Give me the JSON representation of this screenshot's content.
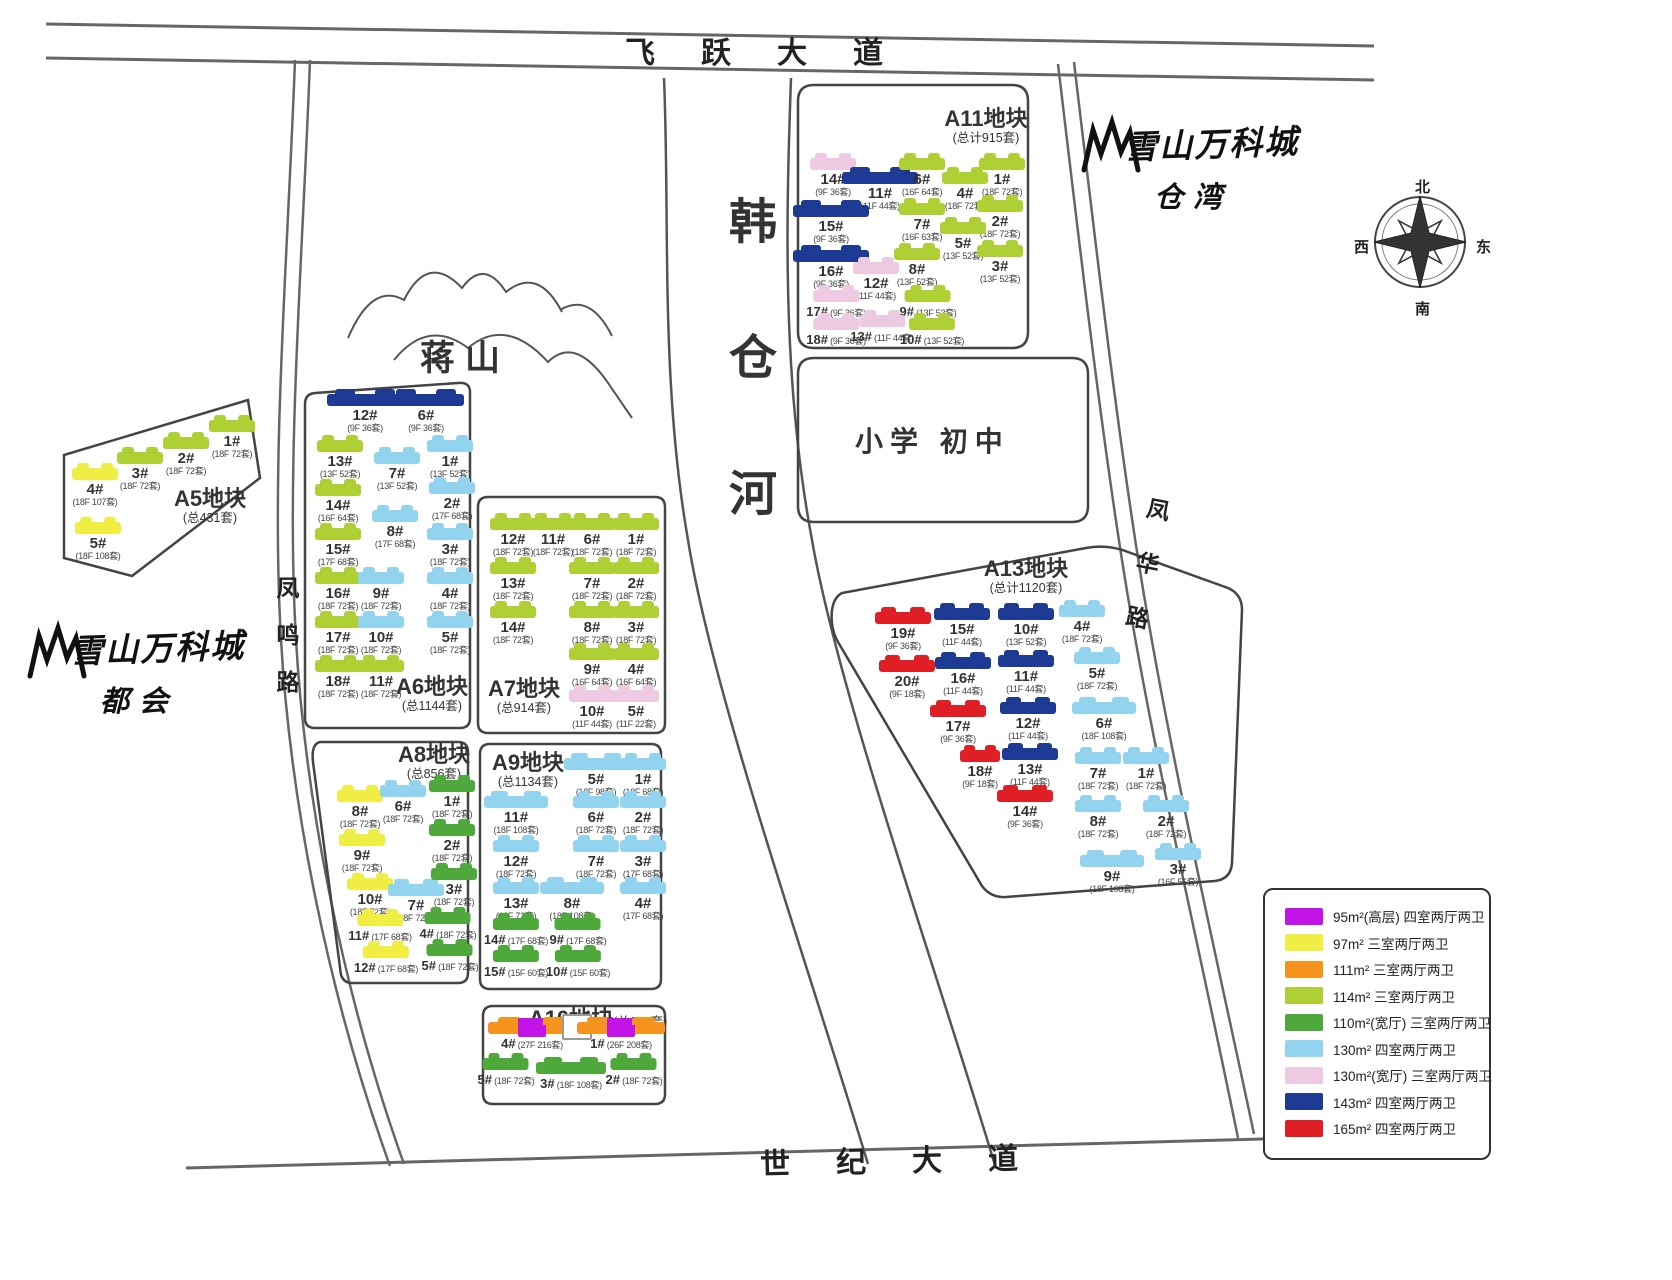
{
  "roads": {
    "top": "飞跃大道",
    "bottom": "世纪大道",
    "left": "凤鸣路",
    "right": "凤华路"
  },
  "features": {
    "river": "韩仓河",
    "mountain": "蒋山",
    "school": "小学 初中"
  },
  "logos": {
    "brand": "雪山万科城",
    "right_sub": "仓湾",
    "left_sub": "都会"
  },
  "compass": {
    "north": "北",
    "south": "南",
    "east": "东",
    "west": "西"
  },
  "type_colors": {
    "t95": "#c213e8",
    "t97": "#f0ee45",
    "t111": "#f6921e",
    "t114": "#aed035",
    "t110w": "#4ea83b",
    "t130": "#92d4f0",
    "t130w": "#eec9e2",
    "t143": "#1d3b94",
    "t165": "#e01e25"
  },
  "legend": {
    "items": [
      {
        "color": "#c213e8",
        "label": "95m²(高层) 四室两厅两卫"
      },
      {
        "color": "#f0ee45",
        "label": "97m² 三室两厅两卫"
      },
      {
        "color": "#f6921e",
        "label": "111m² 三室两厅两卫"
      },
      {
        "color": "#aed035",
        "label": "114m² 三室两厅两卫"
      },
      {
        "color": "#4ea83b",
        "label": "110m²(宽厅) 三室两厅两卫"
      },
      {
        "color": "#92d4f0",
        "label": "130m² 四室两厅两卫"
      },
      {
        "color": "#eec9e2",
        "label": "130m²(宽厅) 三室两厅两卫"
      },
      {
        "color": "#1d3b94",
        "label": "143m² 四室两厅两卫"
      },
      {
        "color": "#e01e25",
        "label": "165m² 四室两厅两卫"
      }
    ]
  },
  "blocks": [
    {
      "id": "A5",
      "title": "A5地块",
      "total": "(总431套)",
      "title_x": 210,
      "title_y": 486,
      "buildings": [
        {
          "n": "1#",
          "s": "(18F 72套)",
          "t": "t114",
          "x": 232,
          "y": 420
        },
        {
          "n": "2#",
          "s": "(18F 72套)",
          "t": "t114",
          "x": 186,
          "y": 437
        },
        {
          "n": "3#",
          "s": "(18F 72套)",
          "t": "t114",
          "x": 140,
          "y": 452
        },
        {
          "n": "4#",
          "s": "(18F 107套)",
          "t": "t97",
          "x": 95,
          "y": 468
        },
        {
          "n": "5#",
          "s": "(18F 108套)",
          "t": "t97",
          "x": 98,
          "y": 522
        }
      ]
    },
    {
      "id": "A6",
      "title": "A6地块",
      "total": "(总1144套)",
      "title_x": 432,
      "title_y": 674,
      "buildings": [
        {
          "n": "12#",
          "s": "(9F 36套)",
          "t": "t143",
          "x": 365,
          "y": 394,
          "w": 76
        },
        {
          "n": "6#",
          "s": "(9F 36套)",
          "t": "t143",
          "x": 426,
          "y": 394,
          "w": 76
        },
        {
          "n": "13#",
          "s": "(13F 52套)",
          "t": "t114",
          "x": 340,
          "y": 440
        },
        {
          "n": "7#",
          "s": "(13F 52套)",
          "t": "t130",
          "x": 397,
          "y": 452
        },
        {
          "n": "1#",
          "s": "(13F 52套)",
          "t": "t130",
          "x": 450,
          "y": 440
        },
        {
          "n": "14#",
          "s": "(16F 64套)",
          "t": "t114",
          "x": 338,
          "y": 484
        },
        {
          "n": "8#",
          "s": "(17F 68套)",
          "t": "t130",
          "x": 395,
          "y": 510
        },
        {
          "n": "2#",
          "s": "(17F 68套)",
          "t": "t130",
          "x": 452,
          "y": 482
        },
        {
          "n": "15#",
          "s": "(17F 68套)",
          "t": "t114",
          "x": 338,
          "y": 528
        },
        {
          "n": "3#",
          "s": "(18F 72套)",
          "t": "t130",
          "x": 450,
          "y": 528
        },
        {
          "n": "16#",
          "s": "(18F 72套)",
          "t": "t114",
          "x": 338,
          "y": 572
        },
        {
          "n": "9#",
          "s": "(18F 72套)",
          "t": "t130",
          "x": 381,
          "y": 572
        },
        {
          "n": "4#",
          "s": "(18F 72套)",
          "t": "t130",
          "x": 450,
          "y": 572
        },
        {
          "n": "17#",
          "s": "(18F 72套)",
          "t": "t114",
          "x": 338,
          "y": 616
        },
        {
          "n": "10#",
          "s": "(18F 72套)",
          "t": "t130",
          "x": 381,
          "y": 616
        },
        {
          "n": "5#",
          "s": "(18F 72套)",
          "t": "t130",
          "x": 450,
          "y": 616
        },
        {
          "n": "18#",
          "s": "(18F 72套)",
          "t": "t114",
          "x": 338,
          "y": 660
        },
        {
          "n": "11#",
          "s": "(18F 72套)",
          "t": "t114",
          "x": 381,
          "y": 660
        }
      ]
    },
    {
      "id": "A7",
      "title": "A7地块",
      "total": "(总914套)",
      "title_x": 524,
      "title_y": 676,
      "buildings": [
        {
          "n": "12#",
          "s": "(18F 72套)",
          "t": "t114",
          "x": 513,
          "y": 518
        },
        {
          "n": "11#",
          "s": "(18F 72套)",
          "t": "t114",
          "x": 553,
          "y": 518
        },
        {
          "n": "6#",
          "s": "(18F 72套)",
          "t": "t114",
          "x": 592,
          "y": 518
        },
        {
          "n": "1#",
          "s": "(18F 72套)",
          "t": "t114",
          "x": 636,
          "y": 518
        },
        {
          "n": "13#",
          "s": "(18F 72套)",
          "t": "t114",
          "x": 513,
          "y": 562
        },
        {
          "n": "7#",
          "s": "(18F 72套)",
          "t": "t114",
          "x": 592,
          "y": 562
        },
        {
          "n": "2#",
          "s": "(18F 72套)",
          "t": "t114",
          "x": 636,
          "y": 562
        },
        {
          "n": "14#",
          "s": "(18F 72套)",
          "t": "t114",
          "x": 513,
          "y": 606
        },
        {
          "n": "8#",
          "s": "(18F 72套)",
          "t": "t114",
          "x": 592,
          "y": 606
        },
        {
          "n": "3#",
          "s": "(18F 72套)",
          "t": "t114",
          "x": 636,
          "y": 606
        },
        {
          "n": "9#",
          "s": "(16F 64套)",
          "t": "t114",
          "x": 592,
          "y": 648
        },
        {
          "n": "4#",
          "s": "(16F 64套)",
          "t": "t114",
          "x": 636,
          "y": 648
        },
        {
          "n": "10#",
          "s": "(11F 44套)",
          "t": "t130w",
          "x": 592,
          "y": 690
        },
        {
          "n": "5#",
          "s": "(11F 22套)",
          "t": "t130w",
          "x": 636,
          "y": 690
        }
      ]
    },
    {
      "id": "A8",
      "title": "A8地块",
      "total": "(总856套)",
      "title_x": 434,
      "title_y": 742,
      "buildings": [
        {
          "n": "8#",
          "s": "(18F 72套)",
          "t": "t97",
          "x": 360,
          "y": 790
        },
        {
          "n": "6#",
          "s": "(18F 72套)",
          "t": "t130",
          "x": 403,
          "y": 785
        },
        {
          "n": "1#",
          "s": "(18F 72套)",
          "t": "t110w",
          "x": 452,
          "y": 780
        },
        {
          "n": "9#",
          "s": "(18F 72套)",
          "t": "t97",
          "x": 362,
          "y": 834
        },
        {
          "n": "2#",
          "s": "(18F 72套)",
          "t": "t110w",
          "x": 452,
          "y": 824
        },
        {
          "n": "10#",
          "s": "(18F 72套)",
          "t": "t97",
          "x": 370,
          "y": 878
        },
        {
          "n": "7#",
          "s": "(18F 72套)",
          "t": "t130",
          "x": 416,
          "y": 884,
          "w": 56
        },
        {
          "n": "3#",
          "s": "(18F 72套)",
          "t": "t110w",
          "x": 454,
          "y": 868
        },
        {
          "n": "11#",
          "s": "(17F 68套)",
          "t": "t97",
          "x": 380,
          "y": 914,
          "il": true
        },
        {
          "n": "4#",
          "s": "(18F 72套)",
          "t": "t110w",
          "x": 448,
          "y": 912,
          "il": true
        },
        {
          "n": "12#",
          "s": "(17F 68套)",
          "t": "t97",
          "x": 386,
          "y": 946,
          "il": true
        },
        {
          "n": "5#",
          "s": "(18F 72套)",
          "t": "t110w",
          "x": 450,
          "y": 944,
          "il": true
        }
      ]
    },
    {
      "id": "A9",
      "title": "A9地块",
      "total": "(总1134套)",
      "title_x": 528,
      "title_y": 750,
      "buildings": [
        {
          "n": "5#",
          "s": "(18F 98套)",
          "t": "t130",
          "x": 596,
          "y": 758,
          "w": 64
        },
        {
          "n": "1#",
          "s": "(18F 68套)",
          "t": "t130",
          "x": 643,
          "y": 758
        },
        {
          "n": "11#",
          "s": "(18F 108套)",
          "t": "t130",
          "x": 516,
          "y": 796,
          "w": 64
        },
        {
          "n": "6#",
          "s": "(18F 72套)",
          "t": "t130",
          "x": 596,
          "y": 796
        },
        {
          "n": "2#",
          "s": "(18F 72套)",
          "t": "t130",
          "x": 643,
          "y": 796
        },
        {
          "n": "12#",
          "s": "(18F 72套)",
          "t": "t130",
          "x": 516,
          "y": 840
        },
        {
          "n": "7#",
          "s": "(18F 72套)",
          "t": "t130",
          "x": 596,
          "y": 840
        },
        {
          "n": "3#",
          "s": "(17F 68套)",
          "t": "t130",
          "x": 643,
          "y": 840
        },
        {
          "n": "13#",
          "s": "(18F 72套)",
          "t": "t130",
          "x": 516,
          "y": 882
        },
        {
          "n": "8#",
          "s": "(18F 108套)",
          "t": "t130",
          "x": 572,
          "y": 882,
          "w": 64
        },
        {
          "n": "4#",
          "s": "(17F 68套)",
          "t": "t130",
          "x": 643,
          "y": 882
        },
        {
          "n": "14#",
          "s": "(17F 68套)",
          "t": "t110w",
          "x": 516,
          "y": 918,
          "il": true
        },
        {
          "n": "9#",
          "s": "(17F 68套)",
          "t": "t110w",
          "x": 578,
          "y": 918,
          "il": true
        },
        {
          "n": "15#",
          "s": "(15F 60套)",
          "t": "t110w",
          "x": 516,
          "y": 950,
          "il": true
        },
        {
          "n": "10#",
          "s": "(15F 60套)",
          "t": "t110w",
          "x": 578,
          "y": 950,
          "il": true
        }
      ]
    },
    {
      "id": "A10",
      "title": "A10地块",
      "total": "(总676套)",
      "title_x": 598,
      "title_y": 1006,
      "inline": true,
      "buildings": [
        {
          "n": "4#",
          "s": "(27F 216套)",
          "t": "t111",
          "c2": "t95",
          "x": 532,
          "y": 1022,
          "w": 88,
          "il": true
        },
        {
          "n": "",
          "s": "",
          "t": "lot",
          "x": 577,
          "y": 1014,
          "w": 26
        },
        {
          "n": "1#",
          "s": "(26F 208套)",
          "t": "t111",
          "c2": "t95",
          "x": 621,
          "y": 1022,
          "w": 88,
          "il": true
        },
        {
          "n": "5#",
          "s": "(18F 72套)",
          "t": "t110w",
          "x": 506,
          "y": 1058,
          "il": true
        },
        {
          "n": "3#",
          "s": "(18F 108套)",
          "t": "t110w",
          "x": 571,
          "y": 1062,
          "w": 70,
          "il": true
        },
        {
          "n": "2#",
          "s": "(18F 72套)",
          "t": "t110w",
          "x": 634,
          "y": 1058,
          "il": true
        }
      ]
    },
    {
      "id": "A11",
      "title": "A11地块",
      "total": "(总计915套)",
      "title_x": 986,
      "title_y": 106,
      "buildings": [
        {
          "n": "14#",
          "s": "(9F 36套)",
          "t": "t130w",
          "x": 833,
          "y": 158
        },
        {
          "n": "11#",
          "s": "(11F 44套)",
          "t": "t143",
          "x": 880,
          "y": 172,
          "w": 76
        },
        {
          "n": "6#",
          "s": "(16F 64套)",
          "t": "t114",
          "x": 922,
          "y": 158
        },
        {
          "n": "4#",
          "s": "(18F 72套)",
          "t": "t114",
          "x": 965,
          "y": 172
        },
        {
          "n": "1#",
          "s": "(18F 72套)",
          "t": "t114",
          "x": 1002,
          "y": 158
        },
        {
          "n": "15#",
          "s": "(9F 36套)",
          "t": "t143",
          "x": 831,
          "y": 205,
          "w": 76
        },
        {
          "n": "7#",
          "s": "(16F 63套)",
          "t": "t114",
          "x": 922,
          "y": 203
        },
        {
          "n": "2#",
          "s": "(18F 72套)",
          "t": "t114",
          "x": 1000,
          "y": 200
        },
        {
          "n": "5#",
          "s": "(13F 52套)",
          "t": "t114",
          "x": 963,
          "y": 222
        },
        {
          "n": "16#",
          "s": "(9F 36套)",
          "t": "t143",
          "x": 831,
          "y": 250,
          "w": 76
        },
        {
          "n": "12#",
          "s": "(11F 44套)",
          "t": "t130w",
          "x": 876,
          "y": 262
        },
        {
          "n": "8#",
          "s": "(13F 52套)",
          "t": "t114",
          "x": 917,
          "y": 248
        },
        {
          "n": "3#",
          "s": "(13F 52套)",
          "t": "t114",
          "x": 1000,
          "y": 245
        },
        {
          "n": "17#",
          "s": "(9F 36套)",
          "t": "t130w",
          "x": 836,
          "y": 290,
          "il": true
        },
        {
          "n": "9#",
          "s": "(13F 52套)",
          "t": "t114",
          "x": 928,
          "y": 290,
          "il": true
        },
        {
          "n": "18#",
          "s": "(9F 36套)",
          "t": "t130w",
          "x": 836,
          "y": 318,
          "il": true
        },
        {
          "n": "13#",
          "s": "(11F 44套)",
          "t": "t130w",
          "x": 882,
          "y": 315,
          "il": true
        },
        {
          "n": "10#",
          "s": "(13F 52套)",
          "t": "t114",
          "x": 932,
          "y": 318,
          "il": true
        }
      ]
    },
    {
      "id": "A13",
      "title": "A13地块",
      "total": "(总计1120套)",
      "title_x": 1026,
      "title_y": 556,
      "buildings": [
        {
          "n": "19#",
          "s": "(9F 36套)",
          "t": "t165",
          "x": 903,
          "y": 612,
          "w": 56
        },
        {
          "n": "15#",
          "s": "(11F 44套)",
          "t": "t143",
          "x": 962,
          "y": 608,
          "w": 56
        },
        {
          "n": "10#",
          "s": "(13F 52套)",
          "t": "t143",
          "x": 1026,
          "y": 608,
          "w": 56
        },
        {
          "n": "4#",
          "s": "(18F 72套)",
          "t": "t130",
          "x": 1082,
          "y": 605
        },
        {
          "n": "20#",
          "s": "(9F 18套)",
          "t": "t165",
          "x": 907,
          "y": 660,
          "w": 56
        },
        {
          "n": "16#",
          "s": "(11F 44套)",
          "t": "t143",
          "x": 963,
          "y": 657,
          "w": 56
        },
        {
          "n": "11#",
          "s": "(11F 44套)",
          "t": "t143",
          "x": 1026,
          "y": 655,
          "w": 56
        },
        {
          "n": "5#",
          "s": "(18F 72套)",
          "t": "t130",
          "x": 1097,
          "y": 652
        },
        {
          "n": "17#",
          "s": "(9F 36套)",
          "t": "t165",
          "x": 958,
          "y": 705,
          "w": 56
        },
        {
          "n": "12#",
          "s": "(11F 44套)",
          "t": "t143",
          "x": 1028,
          "y": 702,
          "w": 56
        },
        {
          "n": "6#",
          "s": "(18F 108套)",
          "t": "t130",
          "x": 1104,
          "y": 702,
          "w": 64
        },
        {
          "n": "18#",
          "s": "(9F 18套)",
          "t": "t165",
          "x": 980,
          "y": 750,
          "w": 40
        },
        {
          "n": "13#",
          "s": "(11F 44套)",
          "t": "t143",
          "x": 1030,
          "y": 748,
          "w": 56
        },
        {
          "n": "7#",
          "s": "(18F 72套)",
          "t": "t130",
          "x": 1098,
          "y": 752
        },
        {
          "n": "1#",
          "s": "(18F 72套)",
          "t": "t130",
          "x": 1146,
          "y": 752
        },
        {
          "n": "14#",
          "s": "(9F 36套)",
          "t": "t165",
          "x": 1025,
          "y": 790,
          "w": 56
        },
        {
          "n": "8#",
          "s": "(18F 72套)",
          "t": "t130",
          "x": 1098,
          "y": 800
        },
        {
          "n": "2#",
          "s": "(18F 72套)",
          "t": "t130",
          "x": 1166,
          "y": 800
        },
        {
          "n": "9#",
          "s": "(18F 108套)",
          "t": "t130",
          "x": 1112,
          "y": 855,
          "w": 64
        },
        {
          "n": "3#",
          "s": "(16F 56套)",
          "t": "t130",
          "x": 1178,
          "y": 848
        }
      ]
    }
  ]
}
